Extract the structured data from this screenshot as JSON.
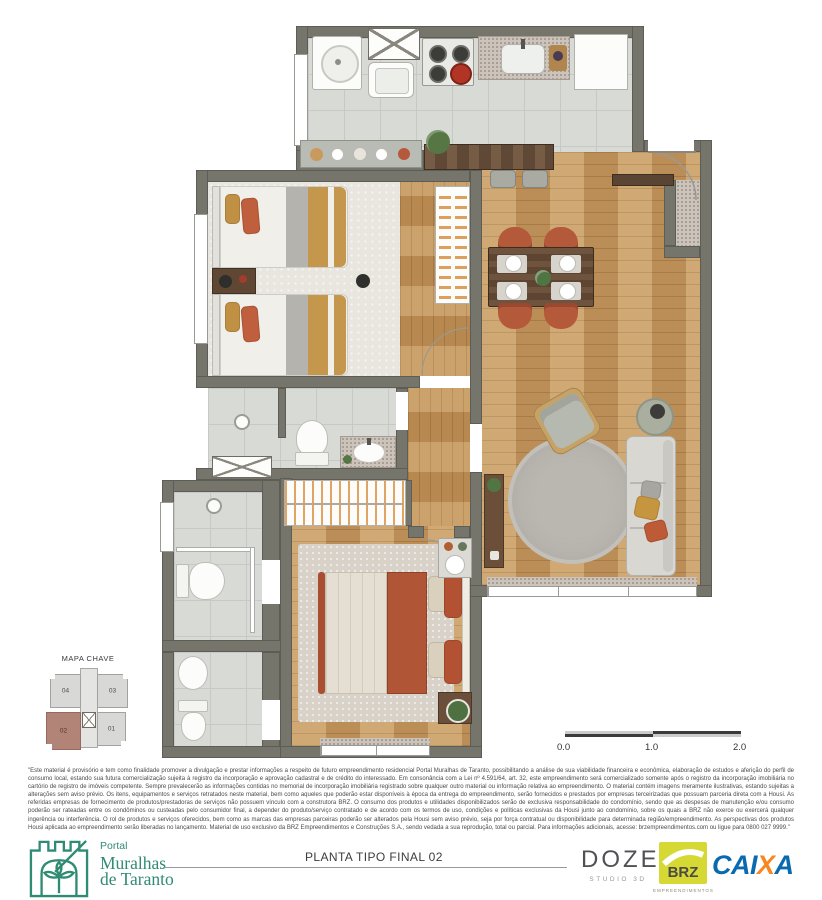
{
  "colors": {
    "brand_green": "#2F8B73",
    "unit_highlight": "#B28377",
    "brz_yellow": "#D6D934",
    "caixa_blue": "#0A6AB0",
    "caixa_orange": "#F6881F",
    "wall_gray": "#76756C",
    "wood": "#C69A62"
  },
  "key_map": {
    "title": "MAPA CHAVE",
    "units": [
      {
        "label": "04",
        "highlighted": false
      },
      {
        "label": "03",
        "highlighted": false
      },
      {
        "label": "02",
        "highlighted": true
      },
      {
        "label": "01",
        "highlighted": false
      }
    ]
  },
  "scale_bar": {
    "labels": [
      "0.0",
      "1.0",
      "2.0"
    ]
  },
  "disclaimer": {
    "text": "\"Este material é provisório e tem como finalidade promover a divulgação e prestar informações a respeito de futuro empreendimento residencial Portal Muralhas de Taranto, possibilitando a análise de sua viabilidade financeira e econômica, elaboração de estudos e aferição do perfil de consumo local, estando sua futura comercialização sujeita à registro da incorporação e aprovação cadastral e de crédito do interessado. Em consonância com a Lei nº 4.591/64, art. 32, este empreendimento será comercializado somente após o registro da incorporação imobiliária no cartório de registro de imóveis competente. Sempre prevalecerão as informações contidas no memorial de incorporação imobiliária registrado sobre qualquer outro material ou informação relativa ao empreendimento. O material contém imagens meramente ilustrativas, estando sujeitas a alterações sem aviso prévio. Os itens, equipamentos e serviços retratados neste material, bem como aqueles que poderão estar disponíveis à época da entrega do empreendimento, serão fornecidos e prestados por empresas terceirizadas que possuam parceria direta com a Housi. As referidas empresas de fornecimento de produtos/prestadoras de serviços não possuem vínculo com a construtora BRZ. O consumo dos produtos e utilidades disponibilizados serão de exclusiva responsabilidade do condomínio, sendo que as despesas de manutenção e/ou consumo poderão ser rateadas entre os condôminos ou custeadas pelo consumidor final, a depender do produto/serviço contratado e de acordo com os termos de uso, condições e políticas exclusivas da Housi junto ao condomínio, sobre os quais a BRZ não exerce ou exercerá qualquer ingerência ou interferência. O rol de produtos e serviços oferecidos, bem como as marcas das empresas parceiras poderão ser alterados pela Housi sem aviso prévio, seja por força contratual ou disponibilidade para determinada região/empreendimento. As perspectivas dos produtos Housi aplicada ao empreendimento serão liberadas no lançamento. Material de uso exclusivo da BRZ Empreendimentos e Construções S.A., sendo vedada a sua reprodução, total ou parcial. Para informações adicionais, acesse: brzempreendimentos.com ou ligue para 0800 027 9999.\""
  },
  "footer": {
    "logo": {
      "pretitle": "Portal",
      "title_line1": "Muralhas",
      "title_line2": "de Taranto"
    },
    "plan_label": "PLANTA TIPO FINAL 02",
    "doze": {
      "name": "DOZE",
      "sub": "STUDIO 3D"
    },
    "brz": {
      "name": "BRZ",
      "sub": "EMPREENDIMENTOS"
    },
    "caixa": {
      "name": "CAIXA",
      "part1": "CAI",
      "part2": "X",
      "part3": "A"
    }
  }
}
